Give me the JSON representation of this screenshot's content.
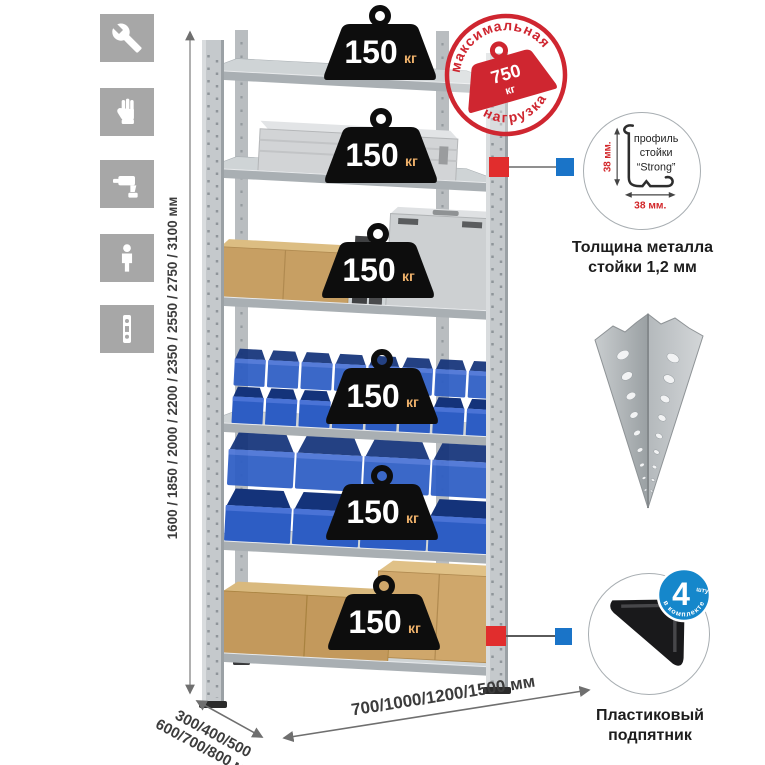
{
  "features": {
    "icons": [
      {
        "name": "wrench-icon"
      },
      {
        "name": "gloves-icon"
      },
      {
        "name": "drill-icon"
      },
      {
        "name": "person-icon"
      },
      {
        "name": "level-icon"
      }
    ]
  },
  "rack": {
    "height_options": "1600 / 1850 / 2000 / 2200 / 2350 / 2550 / 2750 / 3100 мм",
    "depth_options_line1": "300/400/500",
    "depth_options_line2": "600/700/800 мм",
    "width_options": "700/1000/1200/1500 мм",
    "shelf_count": 6,
    "shelf_load_value": "150",
    "shelf_load_unit": "кг"
  },
  "max_load_stamp": {
    "arc_top": "максимальная",
    "arc_bottom": "нагрузка",
    "value": "750",
    "unit": "кг"
  },
  "profile_detail": {
    "label_line1": "профиль",
    "label_line2": "стойки",
    "label_line3": "“Strong”",
    "dim_height": "38 мм.",
    "dim_width": "38 мм.",
    "caption_line1": "Толщина металла",
    "caption_line2": "стойки 1,2 мм"
  },
  "foot_detail": {
    "badge_count": "4",
    "badge_count_suffix": "штуки",
    "badge_arc": "в комплекте",
    "caption_line1": "Пластиковый",
    "caption_line2": "подпятник"
  },
  "colors": {
    "accent_red": "#cf2630",
    "accent_blue": "#1587cb",
    "bin_blue": "#2e5dc4",
    "metal_gray": "#c6cacc",
    "icon_gray": "#a7a7a7",
    "weight_black": "#0d0d0d"
  }
}
